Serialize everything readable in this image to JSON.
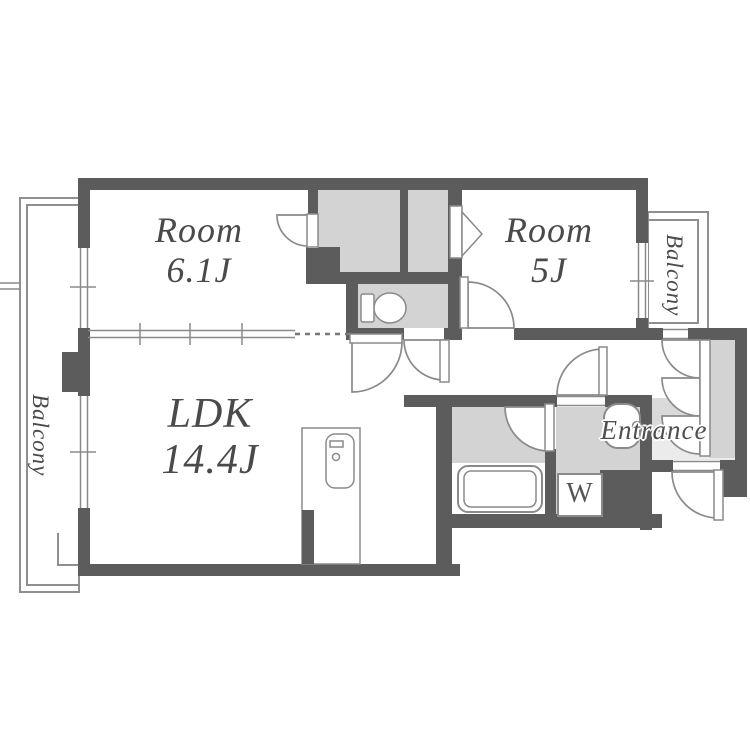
{
  "plan": {
    "rooms": {
      "room1": {
        "name": "Room",
        "size": "6.1J"
      },
      "room2": {
        "name": "Room",
        "size": "5J"
      },
      "ldk": {
        "name": "LDK",
        "size": "14.4J"
      }
    },
    "balcony_left": "Balcony",
    "balcony_right": "Balcony",
    "entrance": "Entrance",
    "washer": "W"
  },
  "colors": {
    "wall": "#5c5c5c",
    "room_fill": "#d3d3d3",
    "entrance_floor": "#dadada",
    "genkan_floor": "#ebebeb",
    "line": "#8a8a8a",
    "text": "#4a4a4a",
    "background": "#ffffff"
  }
}
